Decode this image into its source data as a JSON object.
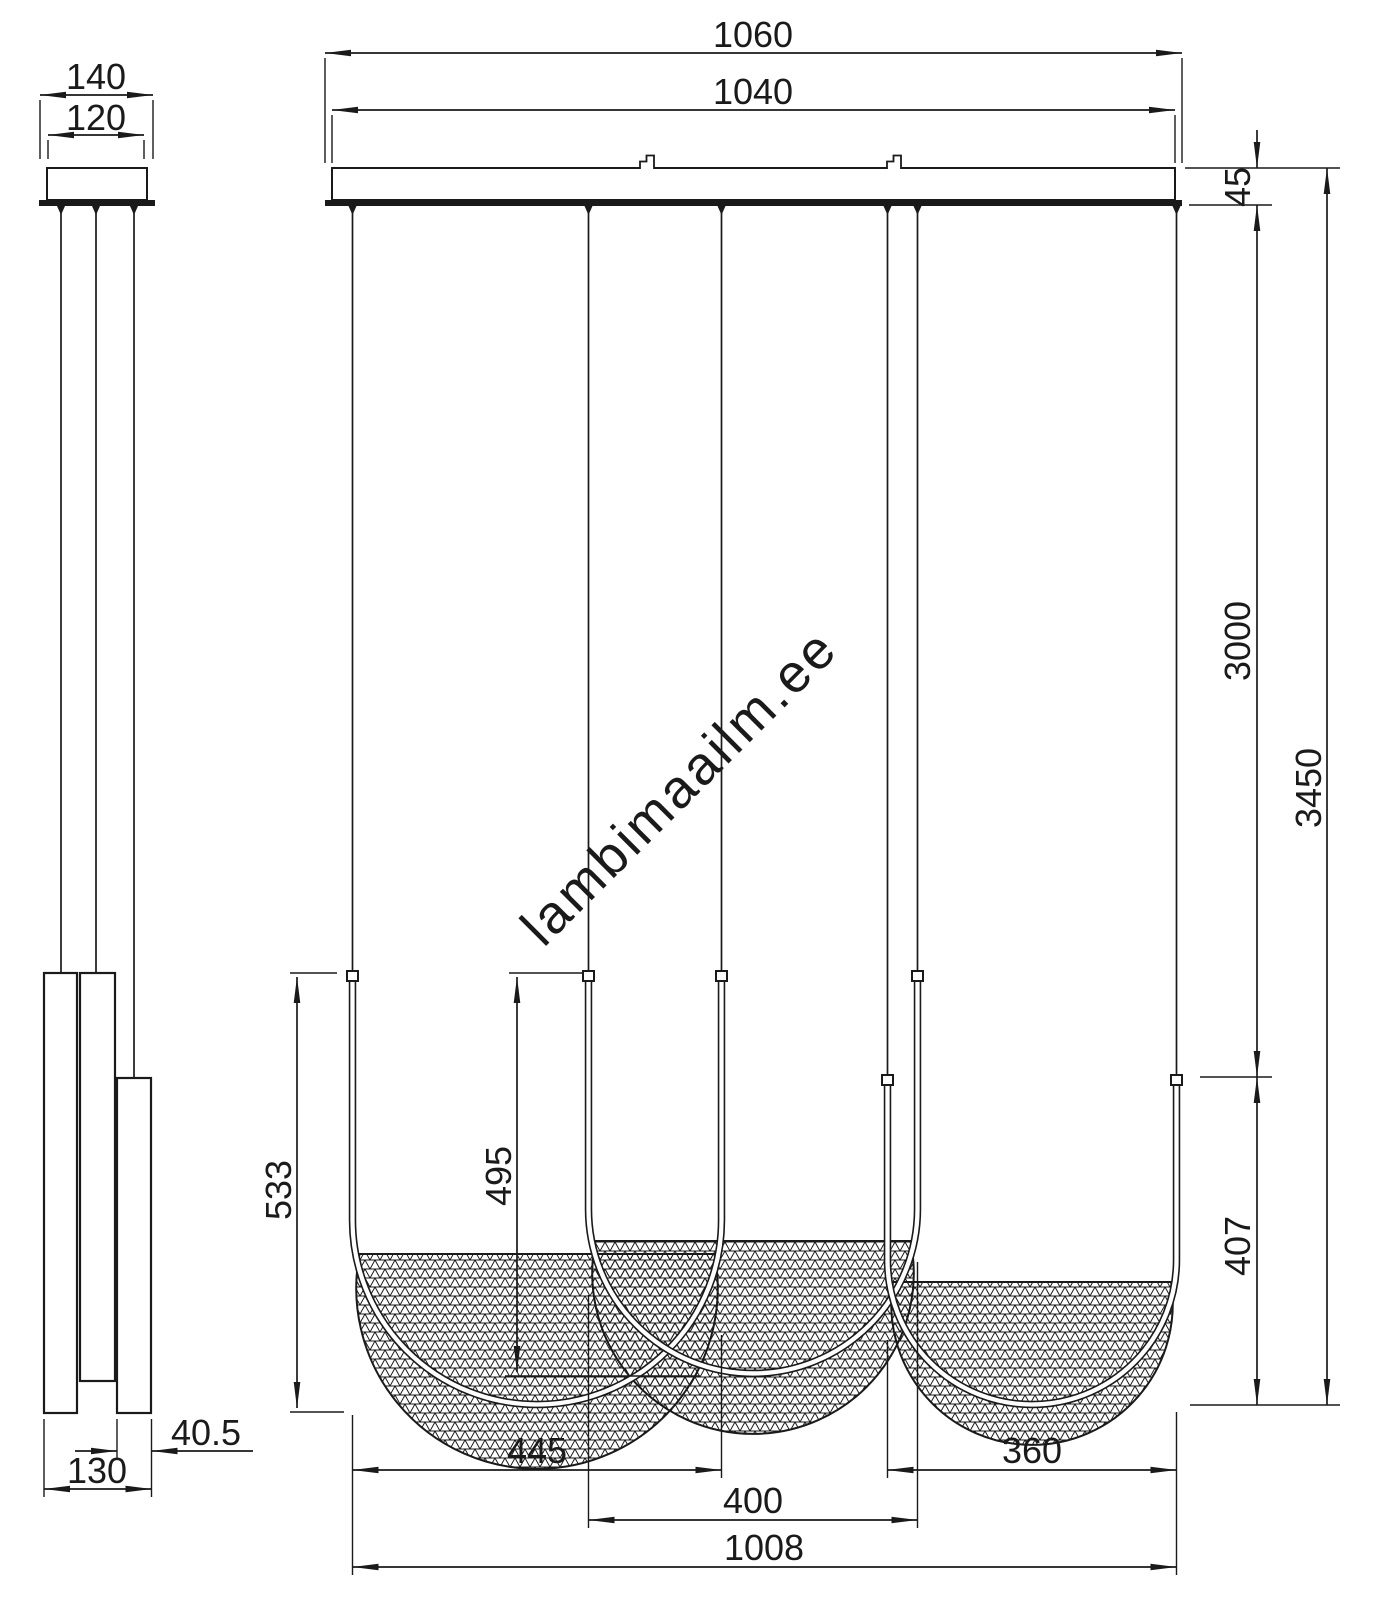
{
  "watermark": {
    "text": "lambimaailm.ee",
    "color": "#cccccc"
  },
  "colors": {
    "line": "#1a1a1a",
    "background": "#ffffff",
    "mesh": "#1a1a1a"
  },
  "side_view": {
    "dims": {
      "canopy_flange_width": "140",
      "canopy_body_width": "120",
      "profile_depth": "40.5",
      "base_width": "130"
    }
  },
  "front_view": {
    "dims": {
      "canopy_flange_length": "1060",
      "canopy_body_length": "1040",
      "canopy_height": "45",
      "suspension_length": "3000",
      "total_height": "3450",
      "pendant3_height": "407",
      "pendant1_height": "533",
      "pendant2_height": "495",
      "pendant1_width": "445",
      "pendant2_width": "400",
      "pendant3_width": "360",
      "overall_width": "1008"
    }
  }
}
